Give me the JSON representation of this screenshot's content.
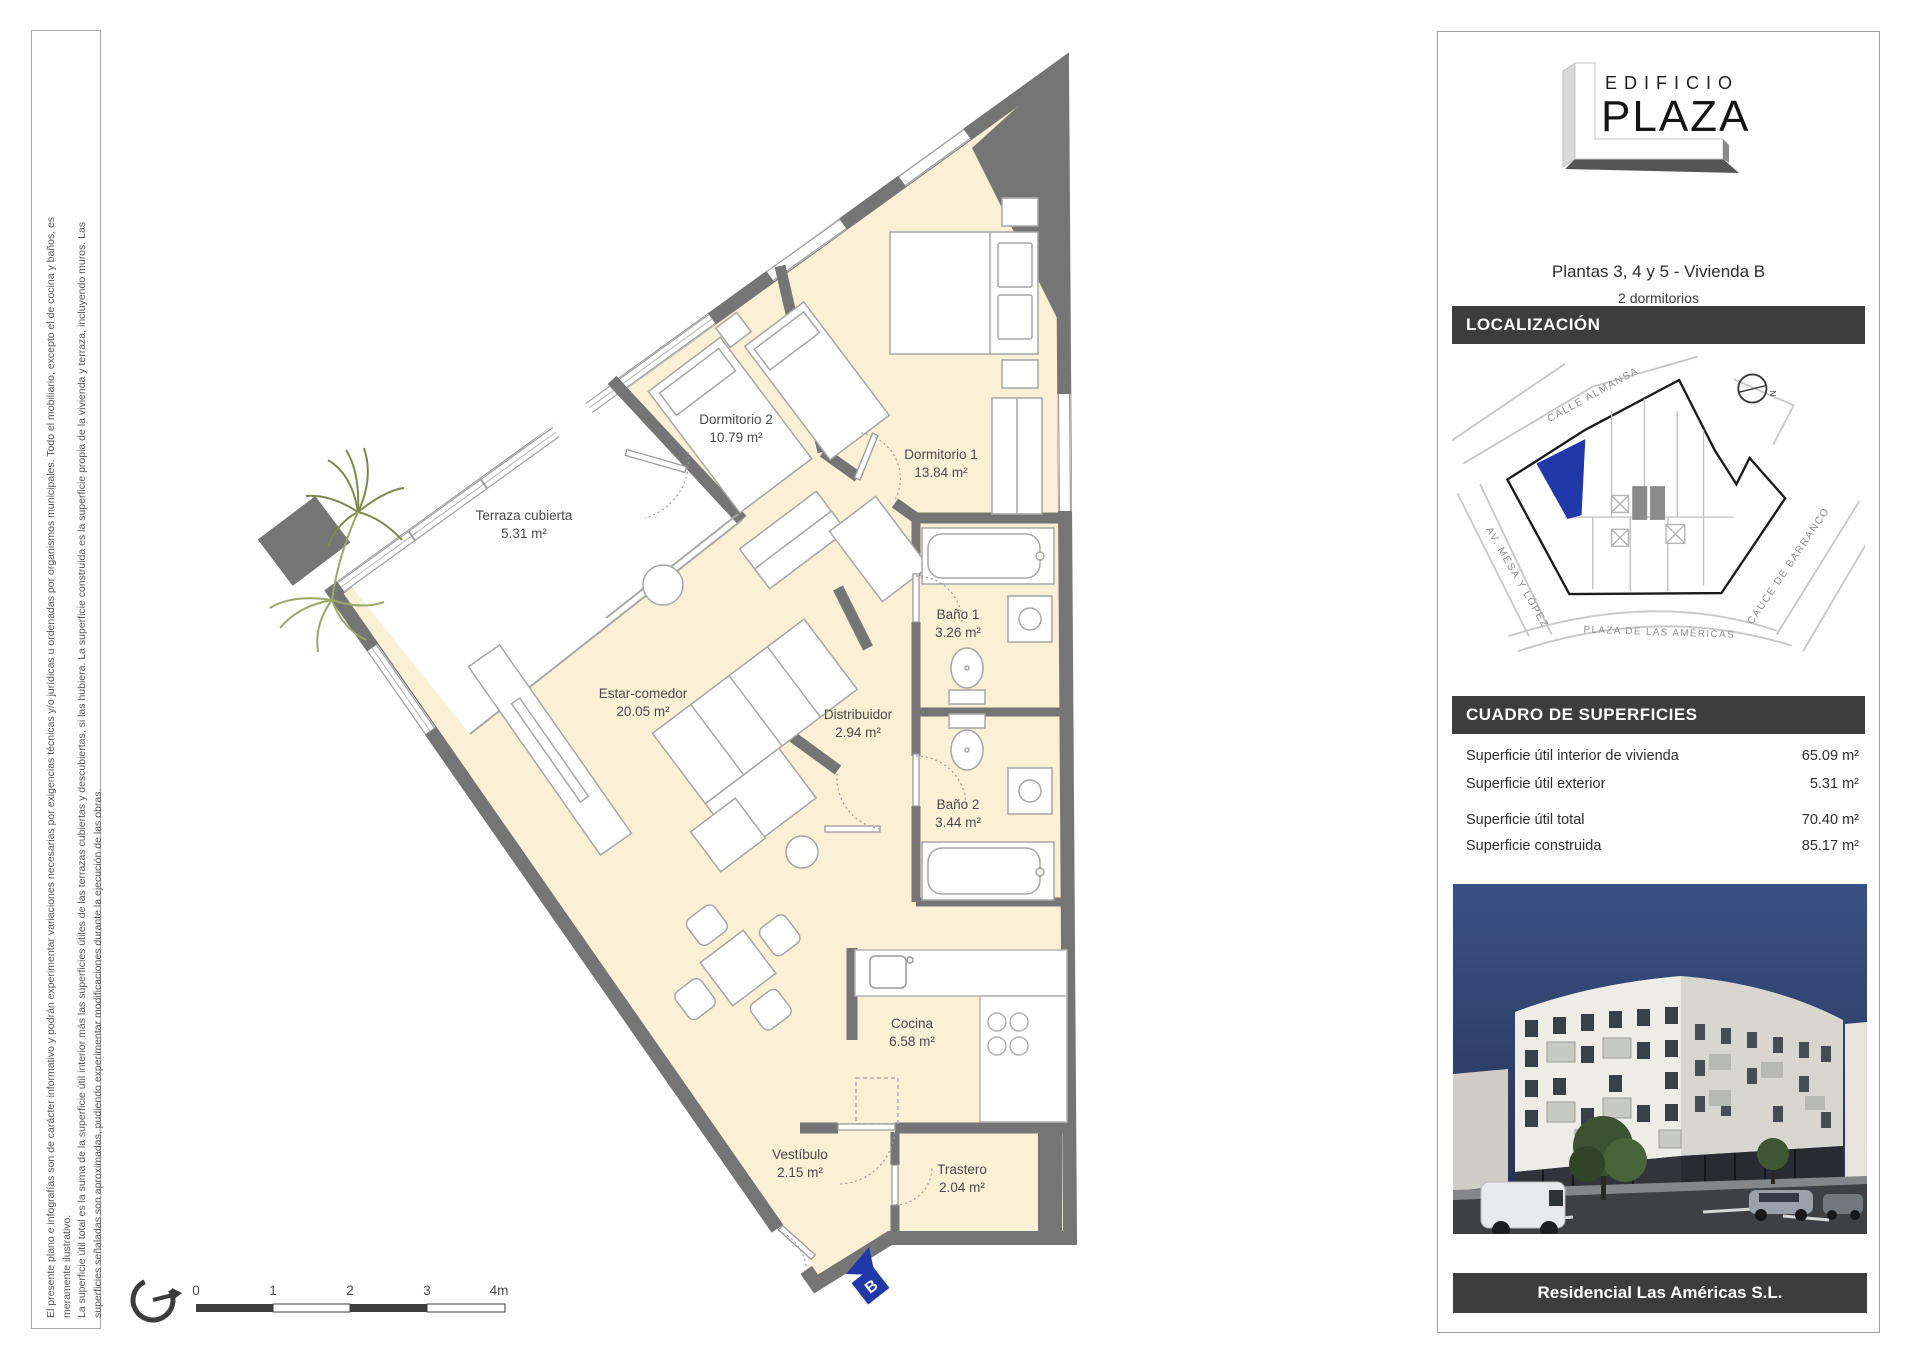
{
  "disclaimer": {
    "line1": "El presente plano e infografías son de carácter informativo y podrán experimentar variaciones necesarias por exigencias técnicas y/o jurídicas u ordenadas por organismos municipales. Todo el mobiliario, excepto el de cocina y baños, es",
    "line2": "meramente ilustrativo.",
    "line3": "La superficie útil total es la suma de la superficie útil interior más las superficies útiles de las terrazas cubiertas y descubiertas, si las hubiera. La superficie construida es la superficie propia de la vivienda y terraza, incluyendo muros. Las",
    "line4": "superficies señaladas son aproximadas, pudiendo experimentar modificaciones durante la ejecución de las obras."
  },
  "plan": {
    "rooms": [
      {
        "name": "Terraza cubierta",
        "area": "5.31 m²"
      },
      {
        "name": "Dormitorio 2",
        "area": "10.79 m²"
      },
      {
        "name": "Dormitorio 1",
        "area": "13.84 m²"
      },
      {
        "name": "Baño 1",
        "area": "3.26 m²"
      },
      {
        "name": "Distribuidor",
        "area": "2.94 m²"
      },
      {
        "name": "Baño 2",
        "area": "3.44 m²"
      },
      {
        "name": "Estar-comedor",
        "area": "20.05 m²"
      },
      {
        "name": "Cocina",
        "area": "6.58 m²"
      },
      {
        "name": "Vestíbulo",
        "area": "2.15 m²"
      },
      {
        "name": "Trastero",
        "area": "2.04 m²"
      }
    ],
    "entrance_label": "B",
    "scale_ticks": [
      "0",
      "1",
      "2",
      "3",
      "4m"
    ]
  },
  "sidebar": {
    "logo_top": "EDIFICIO",
    "logo_main": "PLAZA",
    "title": "Plantas 3, 4 y 5  -  Vivienda B",
    "subtitle": "2 dormitorios",
    "localizacion_heading": "LOCALIZACIÓN",
    "map": {
      "street_top": "CALLE ALMANSA",
      "street_left": "AV. MESA Y LÓPEZ",
      "street_bottom": "PLAZA DE LAS AMÉRICAS",
      "street_right": "CAUCE DE BARRANCO",
      "compass": "N"
    },
    "superficies_heading": "CUADRO DE SUPERFICIES",
    "superficies_rows": [
      {
        "label": "Superficie útil interior de vivienda",
        "value": "65.09 m²"
      },
      {
        "label": "Superficie útil exterior",
        "value": "5.31 m²"
      },
      {
        "label": "Superficie útil total",
        "value": "70.40 m²"
      },
      {
        "label": "Superficie construida",
        "value": "85.17 m²"
      }
    ],
    "footer": "Residencial Las Américas S.L."
  }
}
